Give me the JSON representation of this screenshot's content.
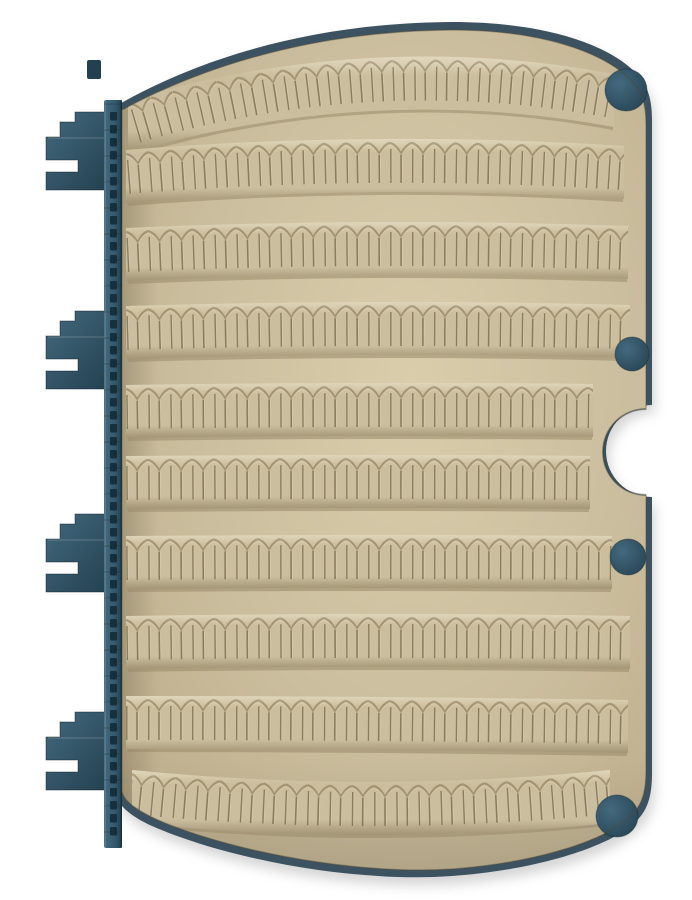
{
  "scene": {
    "subject": "open fly box foam leaf with serrated fly-holding rows and blue hinge spine",
    "canvas": {
      "width": 692,
      "height": 900
    },
    "colors": {
      "background": "#ffffff",
      "foam": "#cbbe9e",
      "foam_light": "#d9cdac",
      "foam_dark": "#b3a482",
      "foam_edge": "#bcad8b",
      "crease": "#a08f6f",
      "crease_highlight": "#ddd1b0",
      "slit": "#8b7c5d",
      "band_shadow": "#998a69",
      "teal": "#35596d",
      "teal_light": "#44697e",
      "teal_dark": "#22404f",
      "slot": "#132b37",
      "back_cover": "#3c5260",
      "back_cover_dark": "#31434e",
      "page_outline": "rgba(80,72,52,0.45)",
      "drop_shadow": "rgba(0,0,0,0.17)"
    },
    "geometry": {
      "page_path": "M 122 110 C 200 68 310 31 452 30 C 542 30 601 52 629 78 C 642 90 646 104 646 124 L 646 409 A 43 43 0 0 0 646 495 L 646 770 C 646 798 640 810 622 823 C 598 842 534 863 452 869 C 360 875 235 853 158 820 C 136 810 122 800 122 790 Z",
      "back_path": "M 116 106 C 196 60 308 23 452 22 C 546 22 608 45 635 72 C 649 86 652 101 652 121 L 652 405 A 46 46 0 0 0 652 497 L 652 772 C 652 801 646 815 628 828 C 602 848 536 870 452 876 C 356 883 230 860 152 826 C 130 816 116 804 116 792 Z",
      "row_height": 53,
      "tooth_width": 22,
      "rows": [
        {
          "x1": 128,
          "x2": 614,
          "yl": 100,
          "ym": 58,
          "yr": 74
        },
        {
          "x1": 126,
          "x2": 624,
          "yl": 150,
          "ym": 139,
          "yr": 146
        },
        {
          "x1": 126,
          "x2": 628,
          "yl": 228,
          "ym": 222,
          "yr": 226
        },
        {
          "x1": 126,
          "x2": 630,
          "yl": 306,
          "ym": 302,
          "yr": 305
        },
        {
          "x1": 126,
          "x2": 593,
          "yl": 385,
          "ym": 383,
          "yr": 384
        },
        {
          "x1": 126,
          "x2": 590,
          "yl": 456,
          "ym": 455,
          "yr": 456
        },
        {
          "x1": 126,
          "x2": 612,
          "yl": 536,
          "ym": 535,
          "yr": 536
        },
        {
          "x1": 126,
          "x2": 630,
          "yl": 616,
          "ym": 614,
          "yr": 616
        },
        {
          "x1": 126,
          "x2": 628,
          "yl": 696,
          "ym": 697,
          "yr": 700
        },
        {
          "x1": 132,
          "x2": 610,
          "yl": 770,
          "ym": 782,
          "yr": 770
        }
      ],
      "spine": {
        "x": 104,
        "width": 18,
        "y1": 100,
        "y2": 848,
        "slot_step": 13,
        "slot_w": 7,
        "slot_h": 8.5,
        "seam_step": 26
      },
      "clip_centers": [
        151,
        350,
        553,
        751
      ],
      "top_tab": {
        "x": 87,
        "y": 60,
        "w": 14,
        "h": 19
      },
      "pegs": [
        {
          "cx": 626,
          "cy": 90,
          "r": 21
        },
        {
          "cx": 632,
          "cy": 354,
          "r": 17
        },
        {
          "cx": 628,
          "cy": 557,
          "r": 18
        },
        {
          "cx": 617,
          "cy": 816,
          "r": 21
        }
      ],
      "shadow_offset": {
        "dx": 3,
        "dy": 8
      }
    }
  }
}
